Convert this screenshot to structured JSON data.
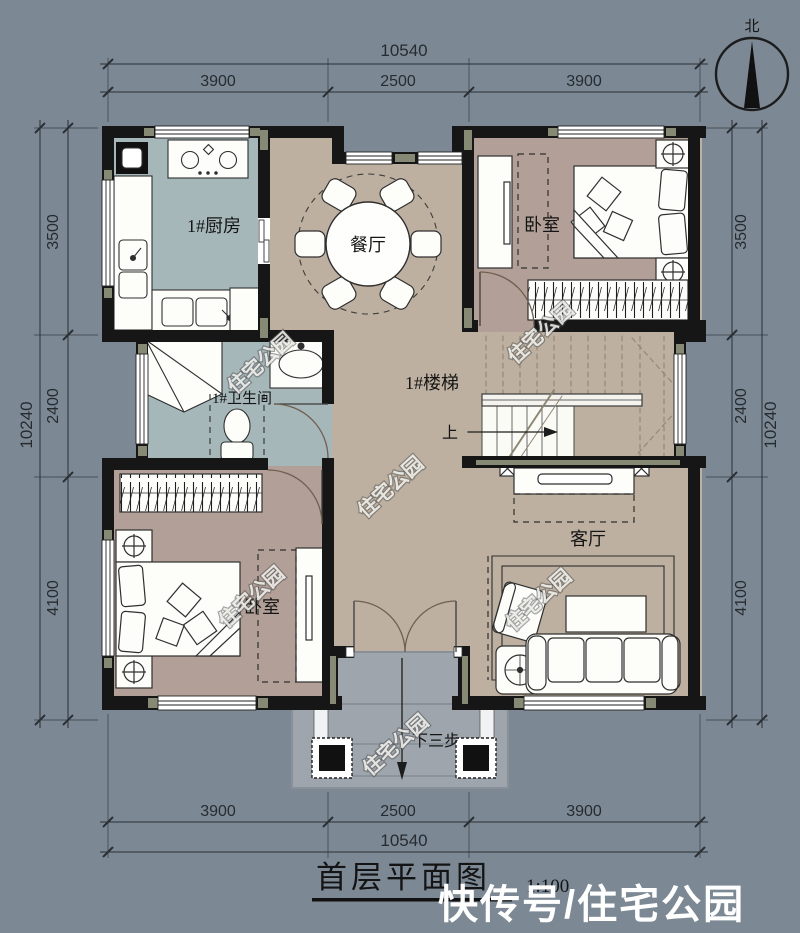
{
  "colors": {
    "background": "#7C8995",
    "wall": "#161616",
    "wall_accent_olive": "#868A74",
    "floor_hall_tan": "#BDB0A0",
    "floor_bedroom_mauve": "#B2A098",
    "floor_wet_blue": "#A6B7BA",
    "porch_gray": "#9EA5AC",
    "furniture_white": "#FDFDFA"
  },
  "compass": {
    "north_label": "北"
  },
  "dims": {
    "top": {
      "total": "10540",
      "segs": [
        "3900",
        "2500",
        "3900"
      ]
    },
    "bottom": {
      "total": "10540",
      "segs": [
        "3900",
        "2500",
        "3900"
      ]
    },
    "left": {
      "total": "10240",
      "segs": [
        "3500",
        "2400",
        "4100"
      ]
    },
    "right": {
      "total": "10240",
      "segs": [
        "3500",
        "2400",
        "4100"
      ]
    }
  },
  "rooms": {
    "kitchen": "1#厨房",
    "dining": "餐厅",
    "bedroom_ne": "卧室",
    "bathroom": "1#卫生间",
    "stairs": "1#楼梯",
    "bedroom_sw": "卧室",
    "living": "客厅"
  },
  "annotations": {
    "up": "上",
    "down_steps": "下三步"
  },
  "title": {
    "name": "首层平面图",
    "scale": "1:100"
  },
  "watermarks": {
    "diagonal": "住宅公园",
    "footer": "快传号/住宅公园"
  }
}
